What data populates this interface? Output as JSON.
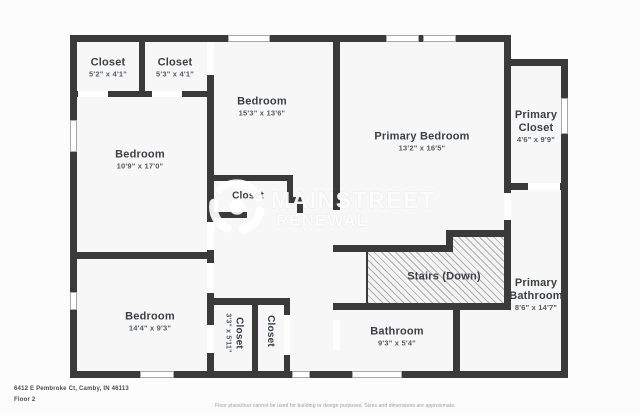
{
  "watermark": {
    "brand_line1": "MAINSTREET",
    "brand_line2": "RENEWAL.",
    "logo_icon": "swirl-aperture-logo"
  },
  "rooms": {
    "closet_a": {
      "name": "Closet",
      "dims": "5'2\" x 4'1\""
    },
    "closet_b": {
      "name": "Closet",
      "dims": "5'3\" x 4'1\""
    },
    "bedroom_top": {
      "name": "Bedroom",
      "dims": "15'3\" x 13'6\""
    },
    "primary_bedroom": {
      "name": "Primary Bedroom",
      "dims": "13'2\" x 16'5\""
    },
    "primary_closet": {
      "name": "Primary Closet",
      "dims": "4'6\" x 9'9\""
    },
    "bedroom_left": {
      "name": "Bedroom",
      "dims": "10'9\" x 17'0\""
    },
    "mid_closet": {
      "name": "Closet"
    },
    "bedroom_bottom": {
      "name": "Bedroom",
      "dims": "14'4\" x 9'3\""
    },
    "closet_c": {
      "name": "Closet",
      "dims": "3'3\" x 5'11\""
    },
    "closet_d": {
      "name": "Closet"
    },
    "bathroom": {
      "name": "Bathroom",
      "dims": "9'3\" x 5'4\""
    },
    "primary_bathroom": {
      "name": "Primary Bathroom",
      "dims": "8'6\" x 14'7\""
    },
    "stairs": {
      "name": "Stairs (Down)"
    }
  },
  "footer": {
    "address": "6412 E Pembroke Ct, Camby, IN 46113",
    "floor": "Floor 2",
    "disclaimer": "Floor plans/tour cannot be used for building or design purposes. Sizes and dimensions are approximate."
  },
  "colors": {
    "wall": "#3a3a3a",
    "room_fill": "#f7f7f7",
    "label_text": "#3b4046"
  }
}
